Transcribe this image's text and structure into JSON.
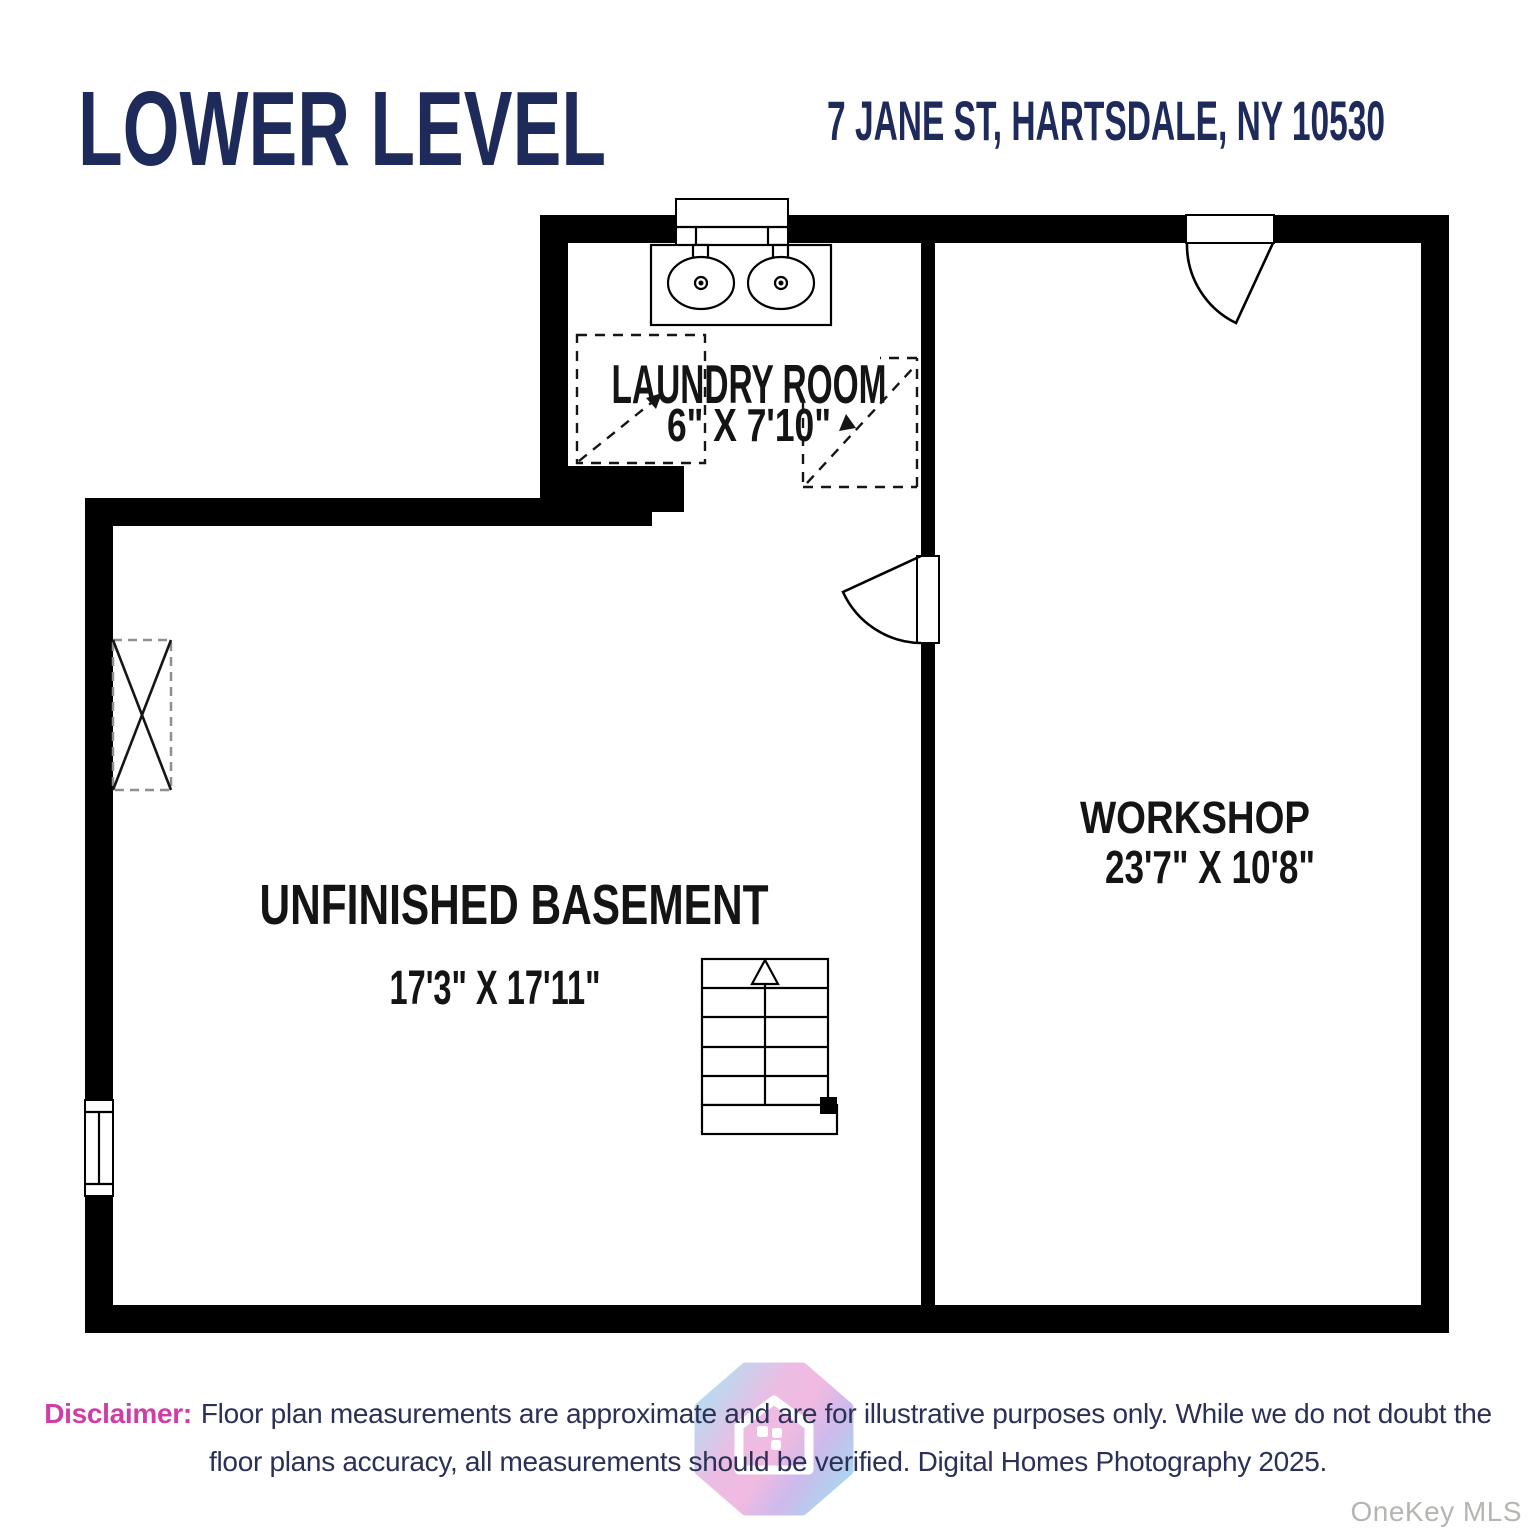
{
  "header": {
    "title": "LOWER LEVEL",
    "address": "7 JANE ST, HARTSDALE, NY 10530"
  },
  "rooms": {
    "laundry": {
      "name": "LAUNDRY ROOM",
      "dims": "6\" X 7'10\""
    },
    "basement": {
      "name": "UNFINISHED BASEMENT",
      "dims": "17'3\" X 17'11\""
    },
    "workshop": {
      "name": "WORKSHOP",
      "dims": "23'7\" X 10'8\""
    }
  },
  "footer": {
    "disclaimer_label": "Disclaimer:",
    "disclaimer_line1": "Floor plan measurements are approximate and are for illustrative purposes only. While we do not doubt the",
    "disclaimer_line2": "floor plans accuracy, all measurements should be verified. Digital Homes Photography 2025.",
    "watermark": "OneKey MLS"
  },
  "colors": {
    "title_navy": "#1e2a5a",
    "disclaimer_magenta": "#cf3ea6",
    "disclaimer_navy": "#2b3156",
    "wall_black": "#000000",
    "watermark_gray": "#b7b5b2",
    "logo_cyan": "#9fd9ef",
    "logo_pink": "#eeacdb",
    "logo_purple": "#c3abe9"
  },
  "icons": {
    "logo": "digital-homes-house-badge-logo",
    "stairs_arrow": "stairs-up-arrow",
    "vanity": "double-sink-vanity",
    "doors": "door-swing-arc",
    "appliances": "dashed-appliance-box",
    "utility": "x-box-utility-marker"
  }
}
